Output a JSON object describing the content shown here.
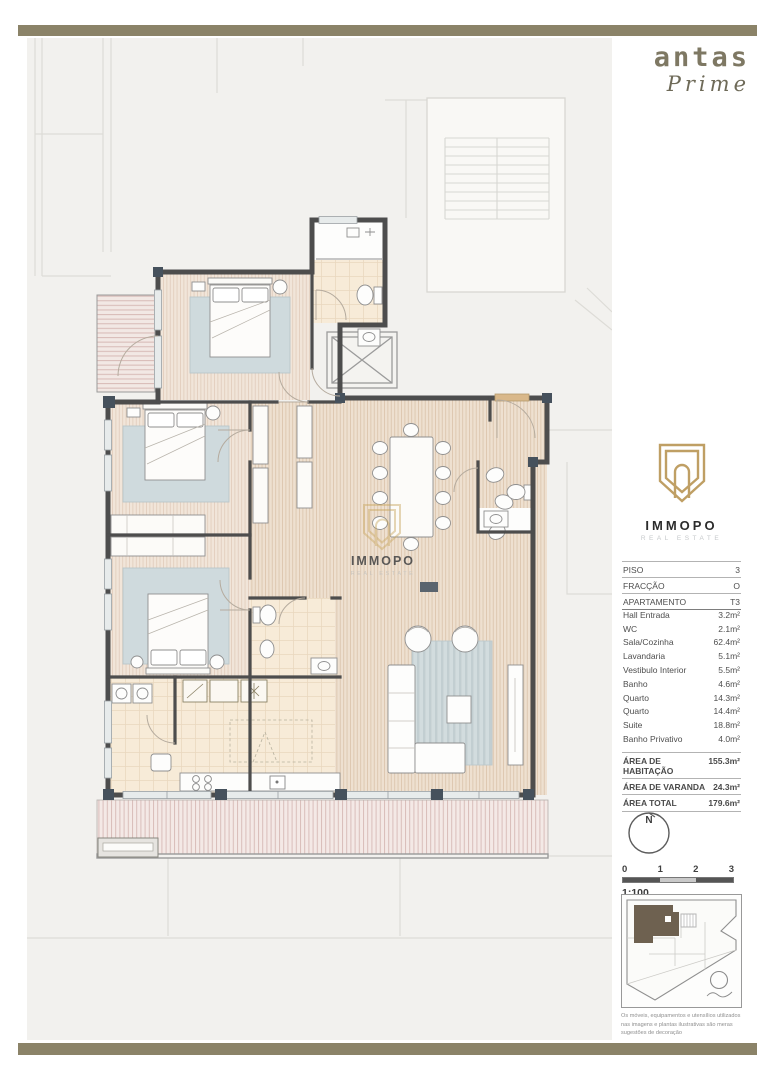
{
  "colors": {
    "accent": "#8b8368",
    "gold": "#bf9f64",
    "wall": "#4d4d4d",
    "unit_fill": "#6e6150"
  },
  "brand": {
    "name": "antas",
    "sub": "Prime"
  },
  "agency": {
    "name": "IMMOPO",
    "sub": "REAL ESTATE"
  },
  "watermark": {
    "name": "IMMOPO",
    "sub": "REAL ESTATE"
  },
  "info": {
    "rows": [
      {
        "label": "PISO",
        "value": "3"
      },
      {
        "label": "FRACÇÃO",
        "value": "O"
      },
      {
        "label": "APARTAMENTO",
        "value": "T3"
      }
    ]
  },
  "rooms": [
    {
      "label": "Hall Entrada",
      "value": "3.2m²"
    },
    {
      "label": "WC",
      "value": "2.1m²"
    },
    {
      "label": "Sala/Cozinha",
      "value": "62.4m²"
    },
    {
      "label": "Lavandaria",
      "value": "5.1m²"
    },
    {
      "label": "Vestibulo Interior",
      "value": "5.5m²"
    },
    {
      "label": "Banho",
      "value": "4.6m²"
    },
    {
      "label": "Quarto",
      "value": "14.3m²"
    },
    {
      "label": "Quarto",
      "value": "14.4m²"
    },
    {
      "label": "Suite",
      "value": "18.8m²"
    },
    {
      "label": "Banho Privativo",
      "value": "4.0m²"
    }
  ],
  "totals": [
    {
      "label": "ÁREA DE HABITAÇÃO",
      "value": "155.3m²"
    },
    {
      "label": "ÁREA DE VARANDA",
      "value": "24.3m²"
    },
    {
      "label": "ÁREA TOTAL",
      "value": "179.6m²"
    }
  ],
  "compass": {
    "label": "N"
  },
  "scale": {
    "ticks": [
      "0",
      "1",
      "2",
      "3"
    ],
    "ratio": "1:100"
  },
  "disclaimer": "Os móveis, equipamentos e utensílios utilizados nas imagens e plantas ilustrativas são meras sugestões de decoração"
}
